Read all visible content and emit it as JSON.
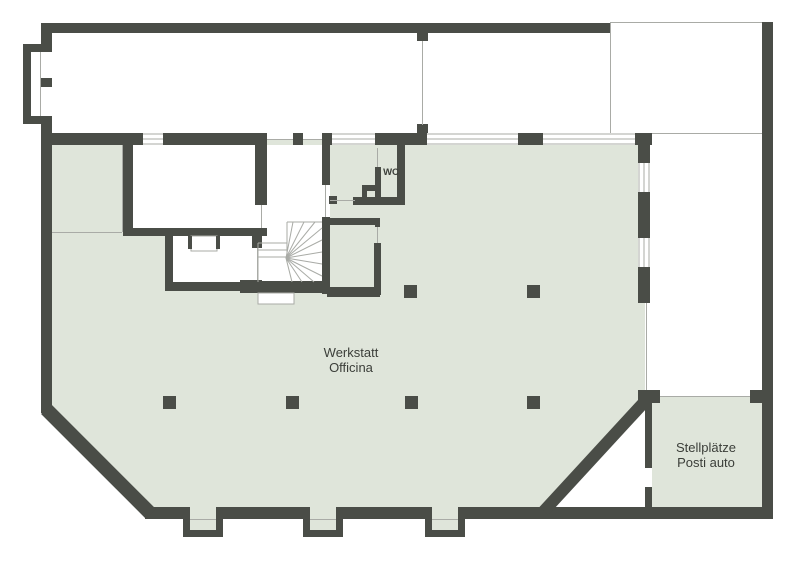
{
  "rooms": {
    "workshop": {
      "name_de": "Werkstatt",
      "name_it": "Officina"
    },
    "parking": {
      "name_de": "Stellplätze",
      "name_it": "Posti auto"
    },
    "wc": {
      "name": "WC"
    }
  },
  "colors": {
    "floor": "#dfe5da",
    "wall": "#4a4d47",
    "line": "#a9aba6",
    "text": "#3b3e39",
    "bg": "#ffffff"
  }
}
